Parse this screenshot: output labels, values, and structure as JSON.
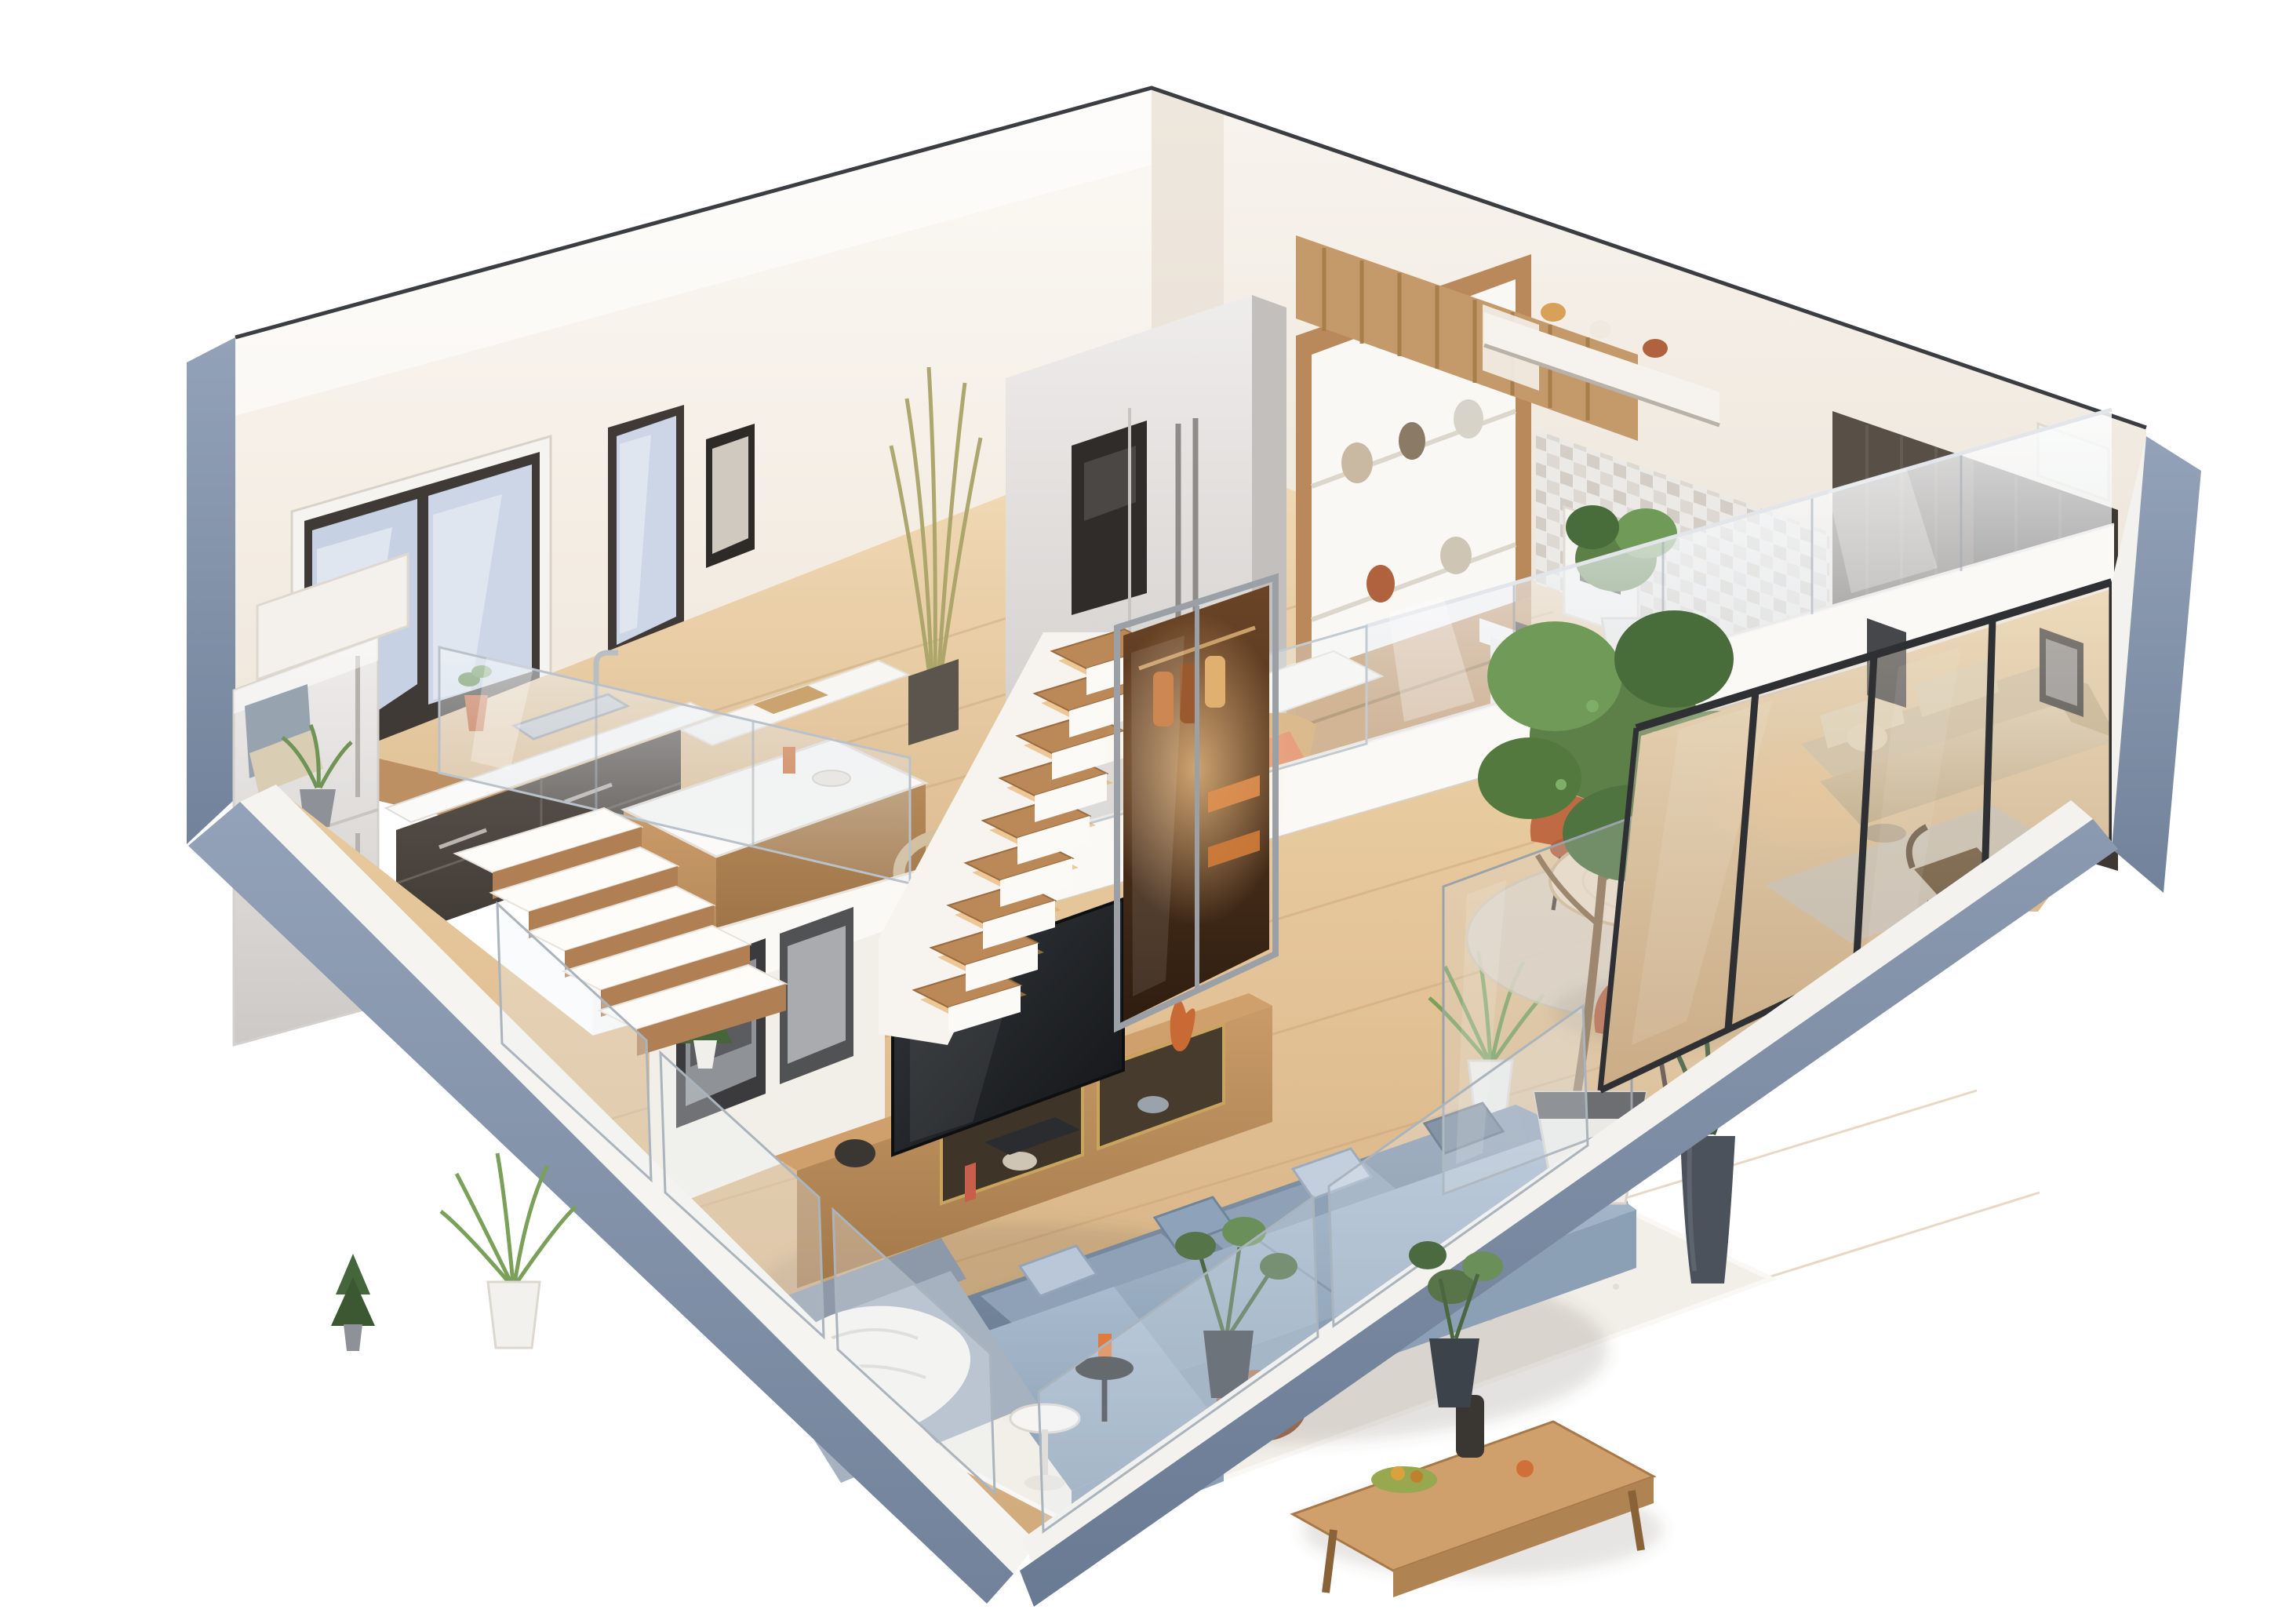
{
  "scene": {
    "kind": "3d-isometric-apartment-floorplan-render",
    "background": "#ffffff",
    "levels": [
      "lower-living-level",
      "raised-kitchen-platform",
      "upper-mezzanine"
    ],
    "rooms": [
      "open-kitchen",
      "breakfast-bar",
      "pantry-kitchen",
      "wardrobe-corner",
      "living-room",
      "tv-area",
      "dining-area",
      "glazed-lounge",
      "balcony-edge"
    ]
  },
  "palette": {
    "wall_white": "#f7f3ed",
    "wall_cut_blue": "#8094ab",
    "slab_blue_dark": "#6f8098",
    "floor_wood_upper": "#e8cda4",
    "floor_wood_lower": "#ddbb8e",
    "cabinet_dark": "#52493f",
    "island_wood": "#b9895c",
    "stair_tread_wood": "#b08054",
    "sofa_blue_gray": "#8799ae",
    "pillow_light_blue": "#b9c7d8",
    "rug_white": "#f2efe9",
    "dining_chair_orange": "#c06a44",
    "lounge_sofa_beige": "#d9c9ab",
    "wardrobe_dark_brown": "#3e3833",
    "window_glass_blue": "#c6d2e4",
    "glass_tint": "#dfe7ee",
    "accent_warm_glow": "#ffc888",
    "tv_black": "#17191b",
    "plant_green": "#5d8049",
    "fridge_gray": "#dcdad8"
  }
}
